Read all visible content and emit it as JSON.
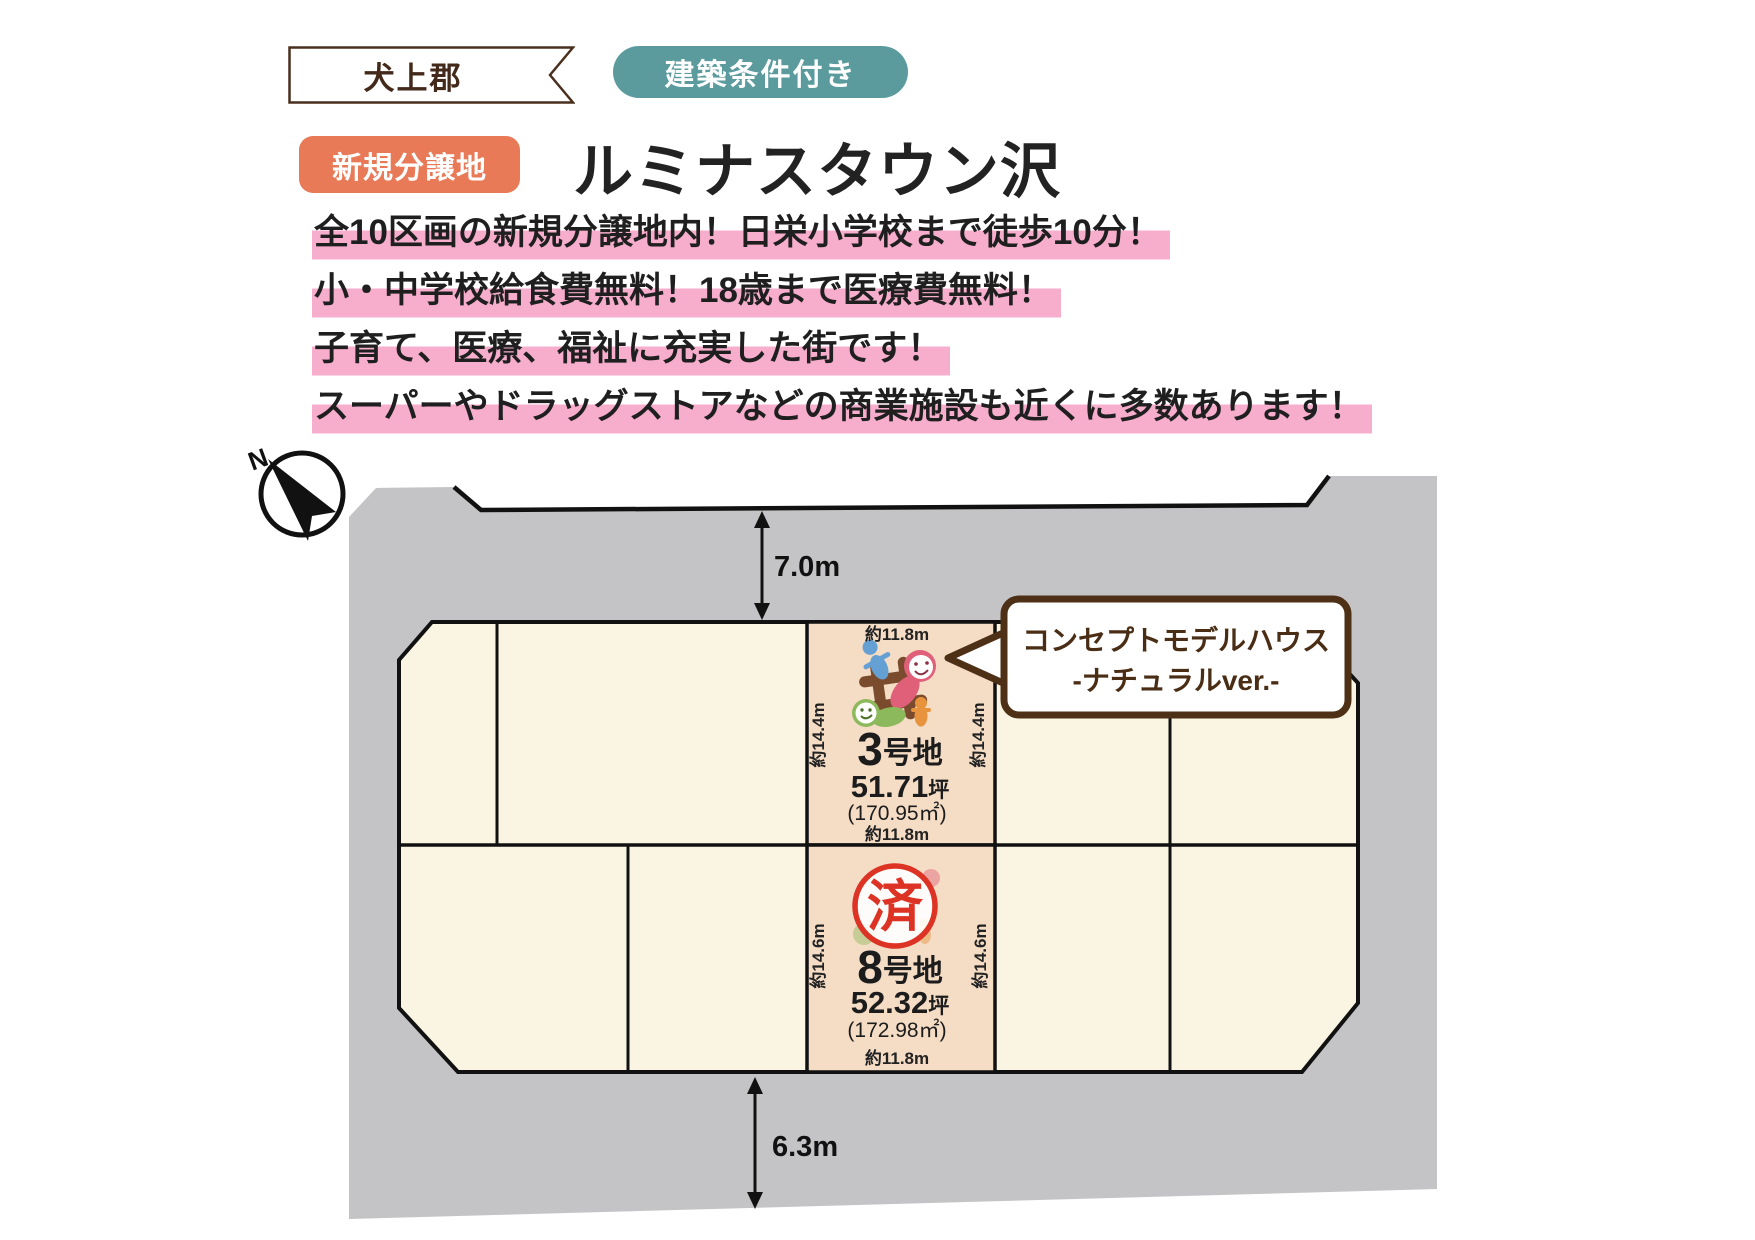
{
  "header": {
    "area_ribbon": "犬上郡",
    "condition_badge": "建築条件付き",
    "new_badge": "新規分譲地",
    "title": "ルミナスタウン沢",
    "highlights": [
      "全10区画の新規分譲地内！日栄小学校まで徒歩10分！",
      "小・中学校給食費無料！18歳まで医療費無料！",
      "子育て、医療、福祉に充実した街です！",
      "スーパーやドラッグストアなどの商業施設も近くに多数あります！"
    ]
  },
  "map": {
    "north_label": "N",
    "road_top_width": "7.0m",
    "road_bottom_width": "6.3m",
    "bubble": {
      "line1": "コンセプトモデルハウス",
      "line2": "-ナチュラルver.-"
    },
    "lot3": {
      "num": "3",
      "num_suffix": "号地",
      "tsubo": "51.71",
      "tsubo_unit": "坪",
      "area": "(170.95㎡)",
      "dim_top": "約11.8m",
      "dim_bottom": "約11.8m",
      "dim_left": "約14.4m",
      "dim_right": "約14.4m"
    },
    "lot8": {
      "num": "8",
      "num_suffix": "号地",
      "tsubo": "52.32",
      "tsubo_unit": "坪",
      "area": "(172.98㎡)",
      "dim_bottom": "約11.8m",
      "dim_left": "約14.6m",
      "dim_right": "約14.6m",
      "sold_stamp": "済"
    },
    "colors": {
      "road_gray": "#c4c3c5",
      "lot_cream": "#faf5e3",
      "lot_featured_peach": "#f4dcc5",
      "highlight_pink": "#f7aecd",
      "badge_teal": "#5b9b9e",
      "badge_orange": "#e87a58",
      "bubble_brown": "#4e3016",
      "stamp_red": "#dd3325"
    }
  }
}
